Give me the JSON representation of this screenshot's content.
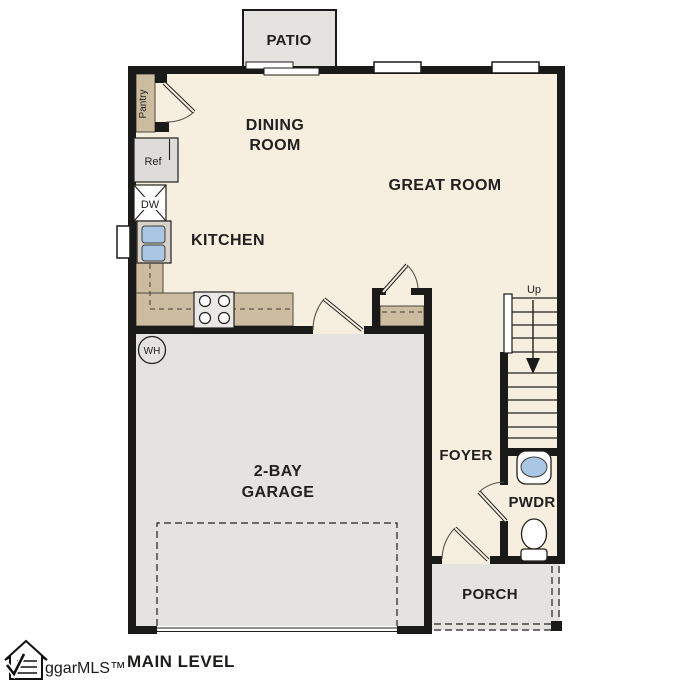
{
  "title": "MAIN LEVEL",
  "colors": {
    "floor": "#f6efdf",
    "garage": "#e4e3e0",
    "counter": "#ccbda1",
    "sinkblue": "#a9c7e5",
    "wall": "#1a1a18"
  },
  "rooms": {
    "patio": "PATIO",
    "dining1": "DINING",
    "dining2": "ROOM",
    "great": "GREAT ROOM",
    "kitchen": "KITCHEN",
    "garage1": "2-BAY",
    "garage2": "GARAGE",
    "foyer": "FOYER",
    "pwdr": "PWDR",
    "porch": "PORCH"
  },
  "fixtures": {
    "pantry": "Pantry",
    "ref": "Ref",
    "dw": "DW",
    "wh": "WH",
    "up": "Up"
  },
  "footer": {
    "level": "MAIN LEVEL",
    "watermark": "ggarMLS™"
  }
}
